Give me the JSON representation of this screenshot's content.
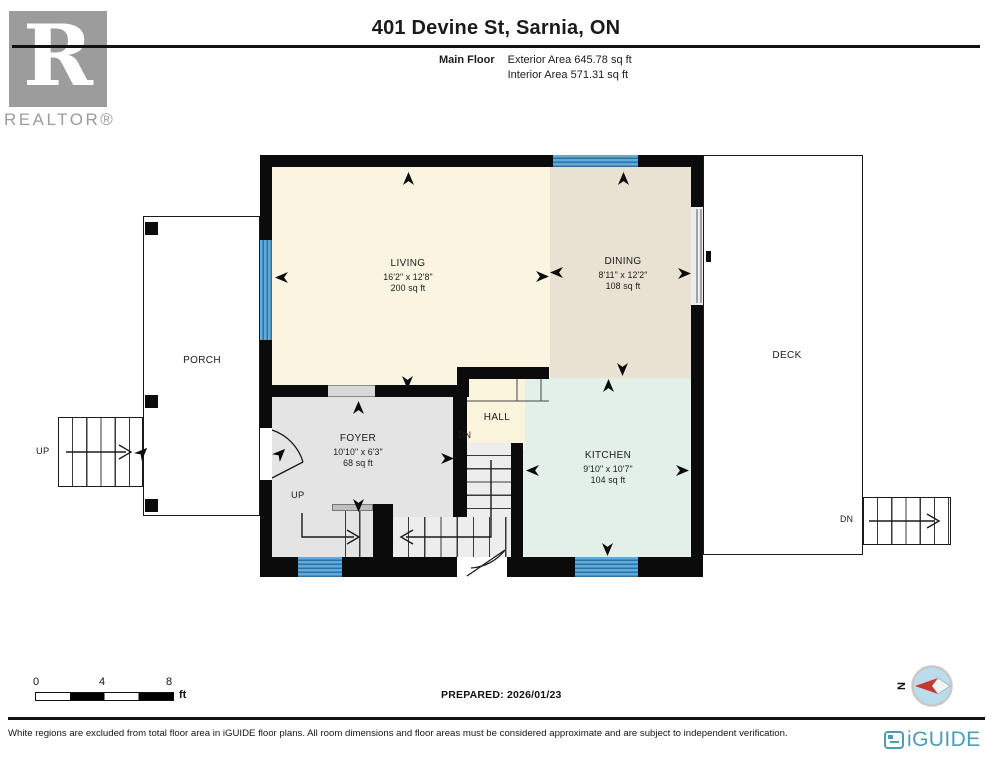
{
  "header": {
    "title": "401 Devine St, Sarnia, ON",
    "floor_label": "Main Floor",
    "exterior_area": "Exterior Area 645.78 sq ft",
    "interior_area": "Interior Area 571.31 sq ft"
  },
  "branding": {
    "realtor_letter": "R",
    "realtor_text": "REALTOR®",
    "iguide_brand": "iGUIDE"
  },
  "plan": {
    "rooms": {
      "living": {
        "name": "LIVING",
        "dims": "16'2\" x 12'8\"",
        "area": "200 sq ft"
      },
      "dining": {
        "name": "DINING",
        "dims": "8'11\" x 12'2\"",
        "area": "108 sq ft"
      },
      "kitchen": {
        "name": "KITCHEN",
        "dims": "9'10\" x 10'7\"",
        "area": "104 sq ft"
      },
      "foyer": {
        "name": "FOYER",
        "dims": "10'10\" x 6'3\"",
        "area": "68 sq ft"
      },
      "hall": {
        "name": "HALL"
      },
      "porch": {
        "name": "PORCH"
      },
      "deck": {
        "name": "DECK"
      }
    },
    "stair_labels": {
      "up": "UP",
      "dn": "DN"
    }
  },
  "scale_bar": {
    "ticks": [
      "0",
      "4",
      "8"
    ],
    "unit": "ft"
  },
  "prepared_label": "PREPARED: 2026/01/23",
  "compass": {
    "north_label": "N"
  },
  "footer": {
    "disclaimer": "White regions are excluded from total floor area in iGUIDE floor plans. All room dimensions and floor areas must be considered approximate and are subject to independent verification.",
    "brand": "iGUIDE"
  },
  "colors": {
    "wall": "#0b0b0b",
    "living_fill": "#faf5e1",
    "dining_fill": "#e9e1d2",
    "kitchen_fill": "#e3efe9",
    "foyer_fill": "#e4e4e4",
    "hall_fill": "#fbf4dc",
    "window_blue": "#5fabdc",
    "window_stripe": "#2f719f",
    "realtor_gray": "#9c9c9c",
    "iguide_teal": "#4c9db4",
    "compass_red": "#c8372d",
    "compass_fill": "#bcdcec"
  }
}
